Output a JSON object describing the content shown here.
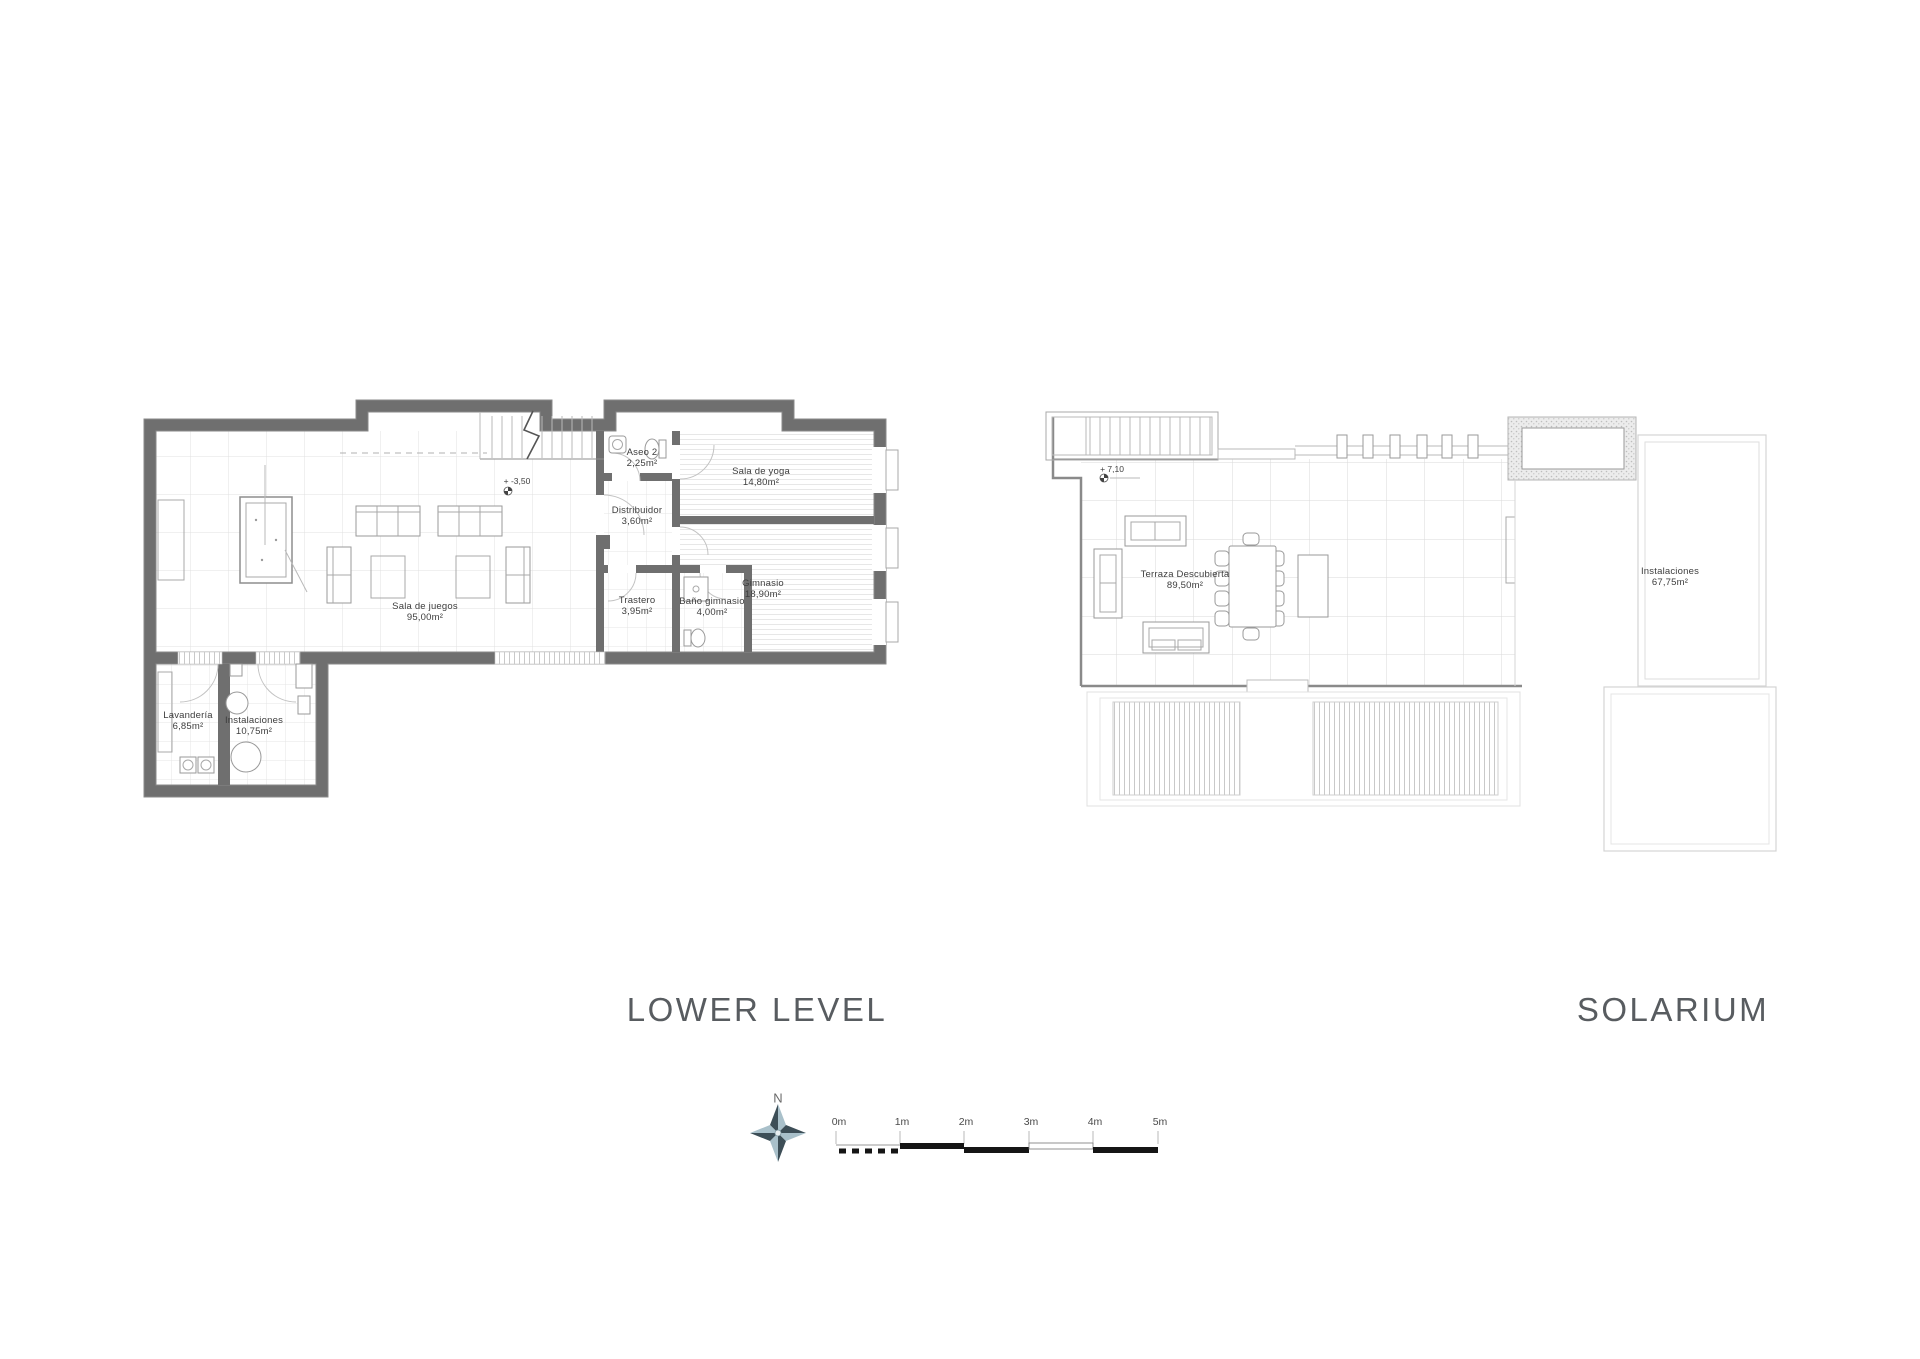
{
  "page": {
    "width": 1920,
    "height": 1359,
    "background": "#ffffff"
  },
  "plans": {
    "lower_level": {
      "title": "LOWER LEVEL",
      "level_marker": "+ -3,50",
      "rooms": [
        {
          "name": "Aseo 2",
          "area": "2,25m²"
        },
        {
          "name": "Sala de yoga",
          "area": "14,80m²"
        },
        {
          "name": "Distribuidor",
          "area": "3,60m²"
        },
        {
          "name": "Gimnasio",
          "area": "18,90m²"
        },
        {
          "name": "Trastero",
          "area": "3,95m²"
        },
        {
          "name": "Baño gimnasio",
          "area": "4,00m²"
        },
        {
          "name": "Sala de juegos",
          "area": "95,00m²"
        },
        {
          "name": "Lavandería",
          "area": "6,85m²"
        },
        {
          "name": "Instalaciones",
          "area": "10,75m²"
        }
      ]
    },
    "solarium": {
      "title": "SOLARIUM",
      "level_marker": "+ 7,10",
      "rooms": [
        {
          "name": "Terraza Descubierta",
          "area": "89,50m²"
        },
        {
          "name": "Instalaciones",
          "area": "67,75m²"
        }
      ]
    }
  },
  "compass": {
    "north_label": "N"
  },
  "scale_bar": {
    "tick_labels": [
      "0m",
      "1m",
      "2m",
      "3m",
      "4m",
      "5m"
    ]
  },
  "colors": {
    "wall": "#6f6f6f",
    "title_text": "#585c60",
    "label_text": "#3d3d3d",
    "line": "#9a9a9a",
    "line_light": "#c9c9c9",
    "compass_dark": "#3d4e57",
    "compass_light": "#a9c0ca",
    "scale_black": "#151515"
  }
}
